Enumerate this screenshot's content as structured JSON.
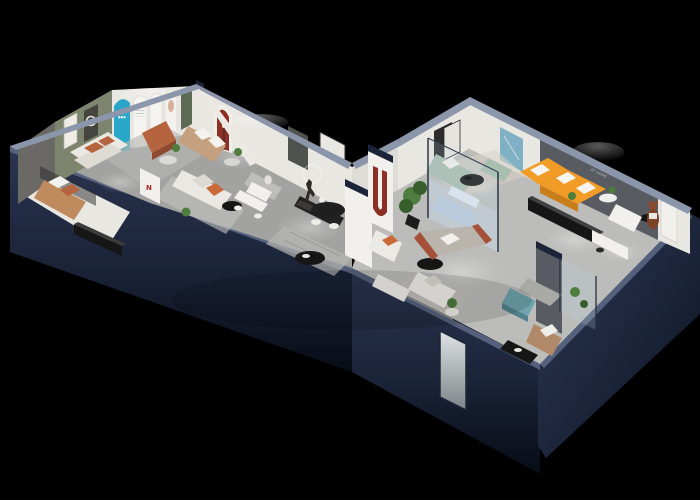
{
  "scene": {
    "title": "3D isometric dollhouse render of a furniture showroom on a black background",
    "background": "#000000"
  },
  "palette": {
    "bg": "#000000",
    "navy": "#27324c",
    "navy-dark": "#0d1322",
    "navy-mid": "#1b2438",
    "navy-top": "#8c96aa",
    "navy-top2": "#55617c",
    "floor": "#a2a3a1",
    "floor-light": "#bcbdbb",
    "floor-white": "#e9e7e2",
    "wall-white": "#e9e7e2",
    "wall-shade": "#cfcdc8",
    "wall-gray": "#585c62",
    "sage": "#7d856e",
    "teal": "#2aa6c9",
    "teal-art": "#7fb0c4",
    "orange": "#f09c26",
    "orange-dk": "#c87f1a",
    "terracotta": "#b5643f",
    "tan": "#c4a07e",
    "red-arch": "#8e2f26",
    "plant": "#4e7d3e",
    "plant-dk": "#375f2c",
    "sage-sofa": "#a9bfb0",
    "wood": "#b08968",
    "teal-ott": "#6fa3ad",
    "ink": "#161616",
    "cream": "#d8d2c4",
    "glass": "#bcd2dd",
    "white": "#f2f0ec"
  },
  "texts": {
    "wall_slogan_line1": "LIFE IS THAT WE GOT TO BE",
    "wall_slogan_line2": "AT HOME",
    "arch_poster_number": "888",
    "column_logo": "N"
  }
}
